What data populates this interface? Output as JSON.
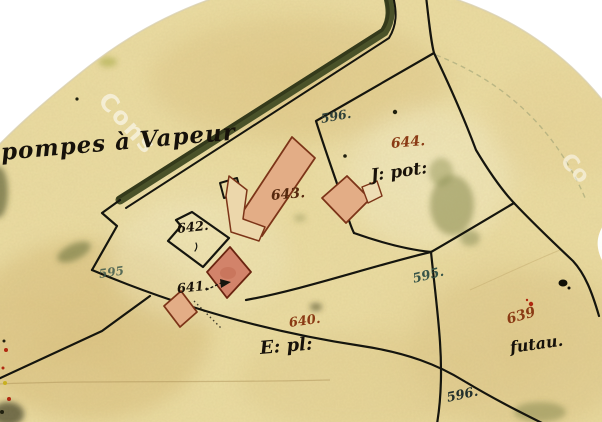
{
  "labels": [
    {
      "name": "pompes-a-vapeur",
      "text": "pompes à Vapeur"
    },
    {
      "name": "parcel-596-top",
      "text": "596."
    },
    {
      "name": "parcel-644",
      "text": "644."
    },
    {
      "name": "jardin-potager",
      "text": "J: pot:"
    },
    {
      "name": "parcel-643",
      "text": "643."
    },
    {
      "name": "parcel-642",
      "text": "642."
    },
    {
      "name": "parcel-641",
      "text": "641."
    },
    {
      "name": "parcel-595-west",
      "text": "595"
    },
    {
      "name": "parcel-595-east",
      "text": "595."
    },
    {
      "name": "parcel-640",
      "text": "640."
    },
    {
      "name": "terrain-e-pl",
      "text": "E: pl:"
    },
    {
      "name": "parcel-639",
      "text": "639"
    },
    {
      "name": "futau",
      "text": "futau."
    },
    {
      "name": "parcel-596-bottom",
      "text": "596."
    }
  ],
  "watermarks": [
    {
      "text": "Cons"
    },
    {
      "text": "Co"
    }
  ],
  "colors": {
    "paper": "#ecdda2",
    "torn_edge_white": "#ffffff",
    "boundary_ink": "#15150e",
    "road_band_green": "#4a5229",
    "building_fill_pink": "#e3ad86",
    "building_fill_cream": "#ecd7ab",
    "building_fill_red": "#d2836a",
    "building_stroke": "#7c3418",
    "label_black": "#16110a",
    "label_red_brown": "#8a3a14",
    "label_teal": "#375448",
    "ink_spot_red": "#b02810"
  }
}
